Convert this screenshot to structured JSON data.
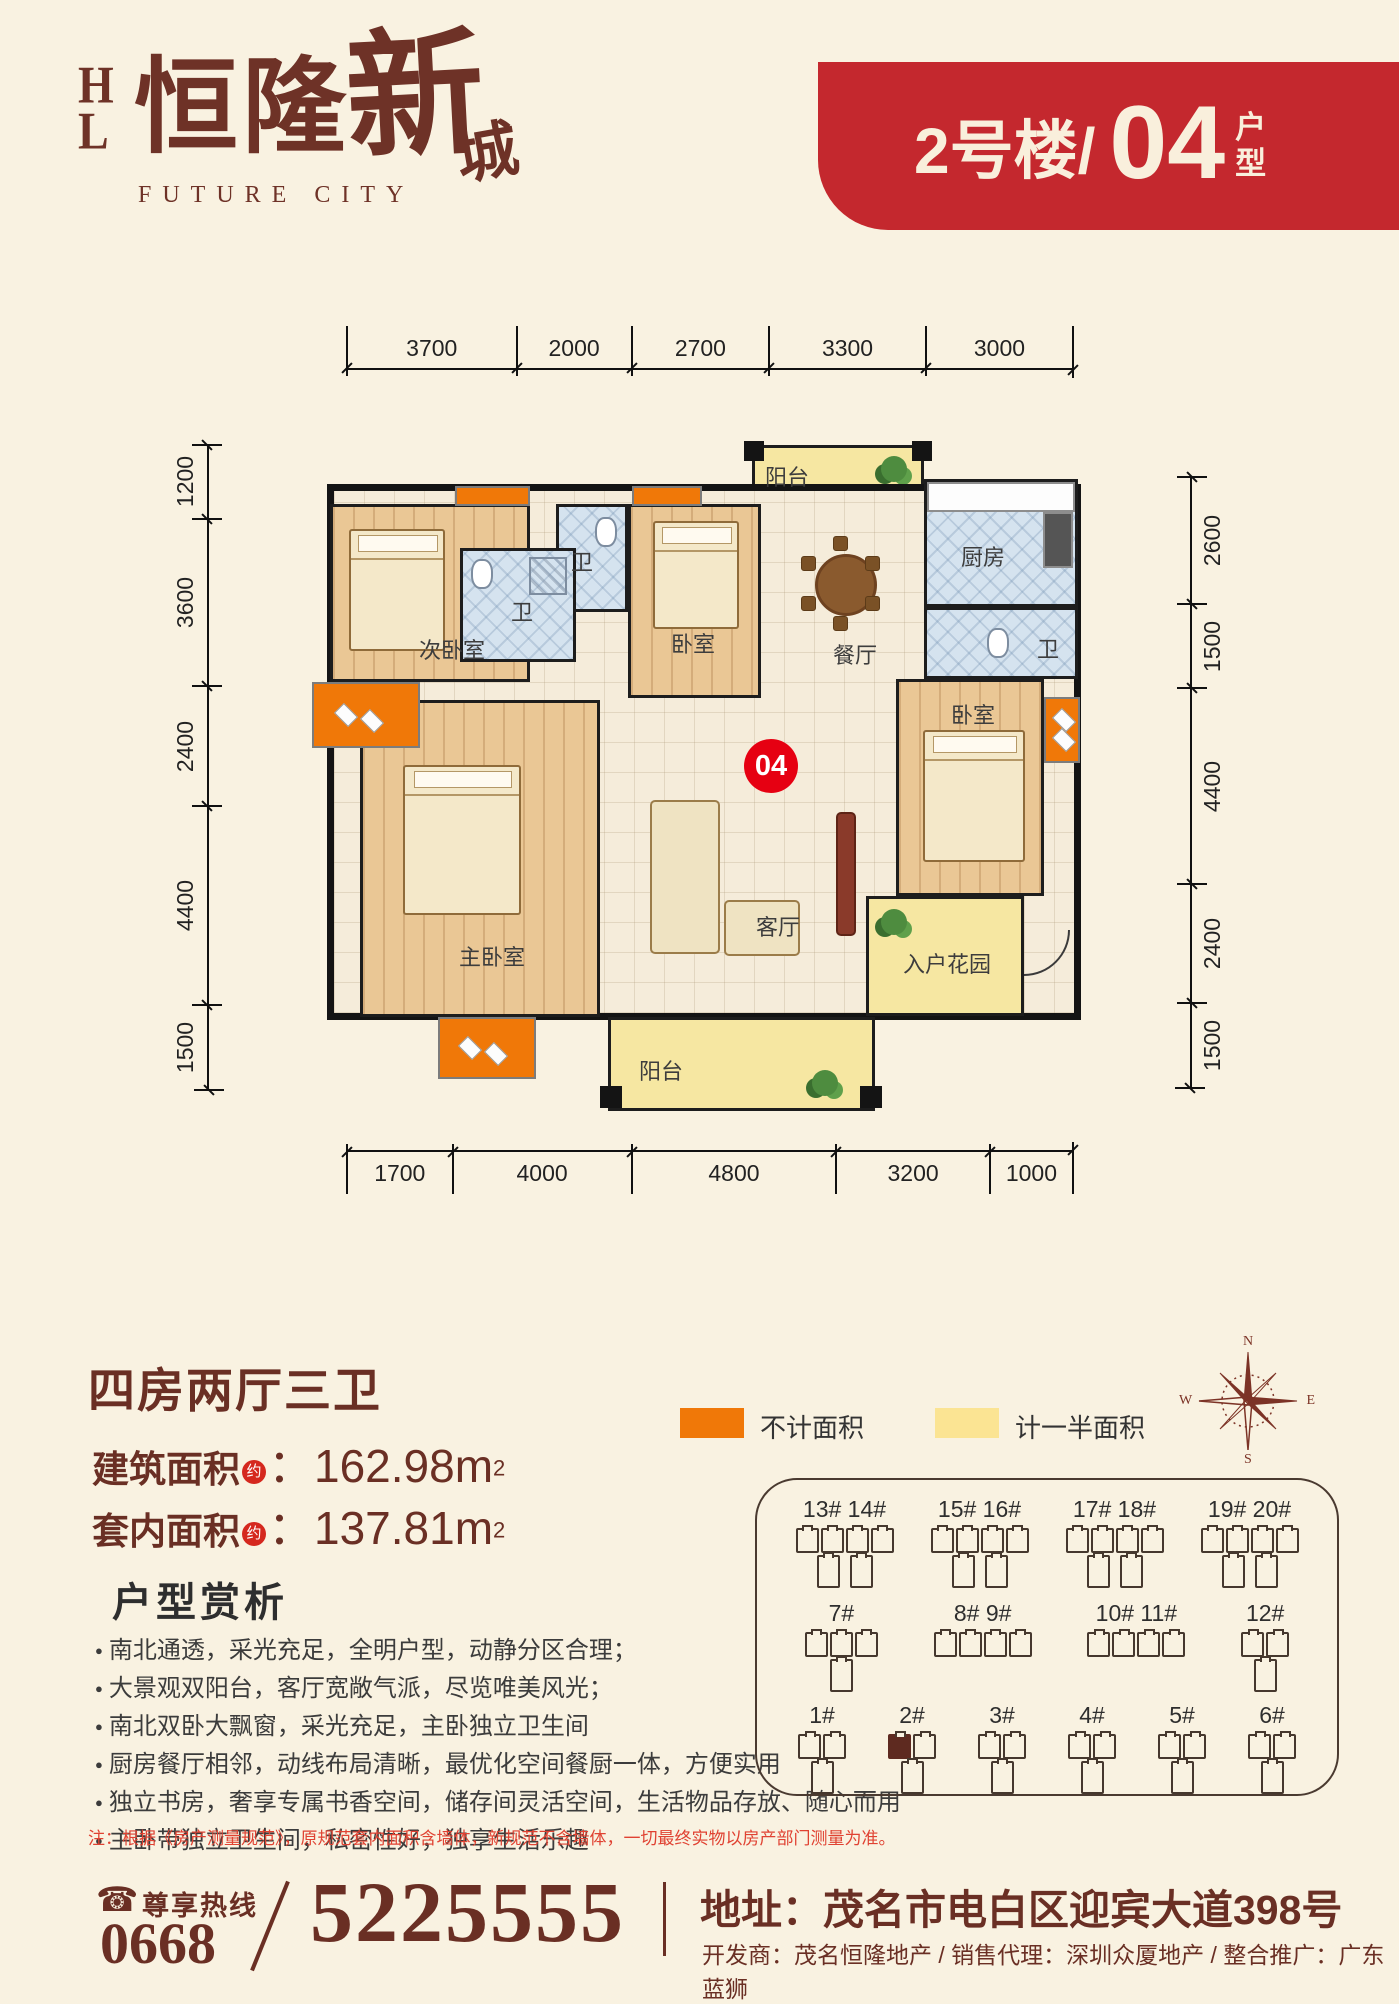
{
  "logo": {
    "monogram": "HL",
    "name_cn": "恒隆",
    "brush_1": "新",
    "brush_2": "城",
    "subtitle": "FUTURE CITY"
  },
  "banner": {
    "building": "2号楼/",
    "unit": "04",
    "suffix": "户型",
    "bg": "#c4282e"
  },
  "floorplan": {
    "unit_badge": "04",
    "dims_top": [
      "3700",
      "2000",
      "2700",
      "3300",
      "3000"
    ],
    "dims_bottom": [
      "1700",
      "4000",
      "4800",
      "3200",
      "1000"
    ],
    "dims_left": [
      "1200",
      "3600",
      "2400",
      "4400",
      "1500"
    ],
    "dims_right": [
      "2600",
      "1500",
      "4400",
      "2400",
      "1500"
    ],
    "rooms": {
      "balcony_top": "阳台",
      "kitchen": "厨房",
      "bath_right": "卫",
      "bedroom_second": "次卧室",
      "bath_top": "卫",
      "bedroom_top": "卧室",
      "dining": "餐厅",
      "bath_mid": "卫",
      "master": "主卧室",
      "living": "客厅",
      "bedroom_right": "卧室",
      "entry_garden": "入户花园",
      "balcony_bottom": "阳台"
    }
  },
  "info": {
    "title": "四房两厅三卫",
    "area_build_label": "建筑面积",
    "area_build_approx": "约",
    "area_build_value": "：162.98m",
    "area_build_sup": "2",
    "area_inner_label": "套内面积",
    "area_inner_approx": "约",
    "area_inner_value": "：137.81m",
    "area_inner_sup": "2"
  },
  "analysis": {
    "heading": "户型赏析",
    "bullets": [
      "南北通透，采光充足，全明户型，动静分区合理；",
      "大景观双阳台，客厅宽敞气派，尽览唯美风光；",
      "南北双卧大飘窗，采光充足，主卧独立卫生间",
      "厨房餐厅相邻，动线布局清晰，最优化空间餐厨一体，方便实用",
      "独立书房，奢享专属书香空间，储存间灵活空间，生活物品存放、随心而用",
      "主卧带独立卫生间，私密性好，独享生活乐趣"
    ]
  },
  "note": "注：根据《房产测量规范》，原规范套内面积含墙体，新规范不含墙体，一切最终实物以房产部门测量为准。",
  "legend": {
    "item1_label": "不计面积",
    "item1_color": "#f07808",
    "item2_label": "计一半面积",
    "item2_color": "#fbe493"
  },
  "compass": {
    "n": "N",
    "e": "E",
    "s": "S",
    "w": "W"
  },
  "sitemap": {
    "rows": [
      [
        {
          "label": "13# 14#",
          "top": 4,
          "bottom": 2
        },
        {
          "label": "15# 16#",
          "top": 4,
          "bottom": 2
        },
        {
          "label": "17# 18#",
          "top": 4,
          "bottom": 2
        },
        {
          "label": "19# 20#",
          "top": 4,
          "bottom": 2
        }
      ],
      [
        {
          "label": "7#",
          "top": 3,
          "bottom": 1
        },
        {
          "label": "8# 9#",
          "top": 4,
          "bottom": 0
        },
        {
          "label": "10# 11#",
          "top": 4,
          "bottom": 0
        },
        {
          "label": "12#",
          "top": 2,
          "bottom": 1
        }
      ],
      [
        {
          "label": "1#",
          "top": 2,
          "bottom": 1
        },
        {
          "label": "2#",
          "top": 2,
          "bottom": 1,
          "highlight": 0
        },
        {
          "label": "3#",
          "top": 2,
          "bottom": 1
        },
        {
          "label": "4#",
          "top": 2,
          "bottom": 1
        },
        {
          "label": "5#",
          "top": 2,
          "bottom": 1
        },
        {
          "label": "6#",
          "top": 2,
          "bottom": 1
        }
      ]
    ]
  },
  "footer": {
    "hotline_label": "尊享热线",
    "area_code": "0668",
    "phone": "5225555",
    "address": "地址：茂名市电白区迎宾大道398号",
    "credits": "开发商：茂名恒隆地产 / 销售代理：深圳众厦地产 / 整合推广：广东蓝狮"
  }
}
